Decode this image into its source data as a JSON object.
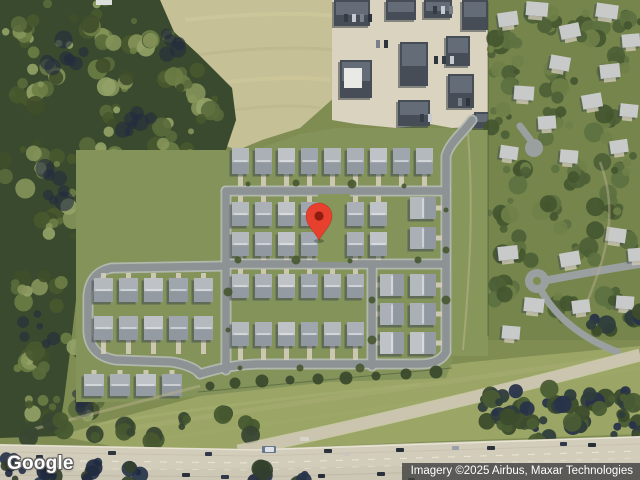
{
  "branding": {
    "logo": "Google"
  },
  "attribution": {
    "text": "Imagery ©2025 Airbus, Maxar Technologies",
    "bg": "#424242",
    "fg": "#ffffff"
  },
  "marker": {
    "cx": 319,
    "cy": 216,
    "tipY": 240,
    "r": 13,
    "color": "#E8402F",
    "inner_color": "#8E1D10",
    "inner_r": 4.6
  },
  "palette": {
    "grass": "#7f8d52",
    "slope": "#9ba566",
    "field": "#c6c096",
    "forest_base": "#3a4a2e",
    "forest_shadow": "#232c40",
    "sub_base": "#83935a",
    "belt": "#87975c",
    "road_edge": "#b7bbb6",
    "road": "#8d9394",
    "drive": "#d3cdba",
    "pavement": "#dad3bf",
    "building": "#474d57",
    "building_top": "#6b7480",
    "roofs": [
      "#b4b9be",
      "#aab0b6",
      "#bfc3c7",
      "#9fa6ad"
    ],
    "roof_front": "#8d949c",
    "roof_ridge": "#e8eaec",
    "house_shadow": "#3c4450",
    "hood_roof": "#c7cac9",
    "hood_grass": "#75854b",
    "highway": "#d2ccba",
    "frontage": "#cbc5b0",
    "forest_trees": [
      "#5a6c3c",
      "#48592f",
      "#6d7e46",
      "#86955a",
      "#3f4e2a",
      "#93a367"
    ],
    "hood_trees": [
      "#4c5f36",
      "#5d7040",
      "#44552f",
      "#6f8148"
    ],
    "band_trees": [
      "#3c4c2c",
      "#2f3d3c",
      "#4a5c34",
      "#28334a"
    ],
    "strip_trees": [
      "#47582f",
      "#394733"
    ],
    "overlay_trees": [
      "#26334a",
      "#33402c",
      "#1f2a40"
    ]
  },
  "scene": {
    "polys": {
      "field": "150,0 336,0 336,96 300,128 262,140 238,150 226,146 236,120 232,88 198,54 174,32 160,0",
      "slope": "60,436 110,420 200,396 330,380 470,362 640,346 640,434 420,442 240,450 120,448",
      "forest": "0,0 160,0 174,32 198,54 232,88 236,120 226,150 236,162 230,198 204,234 168,252 120,258 86,264 76,300 70,352 64,400 58,436 0,438",
      "commercial": "332,0 490,0 490,126 452,128 430,124 396,128 356,124 332,120",
      "sub_base": "76,150 226,150 238,156 300,134 336,128 452,128 452,362 446,378 330,382 200,396 140,402 76,402",
      "highway": "0,444 150,447 255,449 420,443 640,436 640,480 0,480",
      "highway_lower": "0,472 640,462 640,480 0,480"
    },
    "belt": {
      "x": 452,
      "y": 130,
      "w": 36,
      "h": 226
    },
    "white_box": {
      "x": 96,
      "y": 0,
      "w": 16,
      "h": 5
    },
    "gap_patch": {
      "x": 318,
      "y": 194,
      "w": 32,
      "h": 68
    },
    "sub_roads": [
      "M472,120 C462,134 450,142 446,156 L446,352",
      "M226,191 L446,191",
      "M226,191 L226,370",
      "M226,264 L446,264",
      "M372,264 L372,366",
      "M200,374 Q232,364 260,364 L420,364 Q440,364 446,352",
      "M226,266 L112,268",
      "M112,268 Q90,272 88,296 L88,332 Q90,356 116,360 L172,362 Q194,366 200,374"
    ],
    "hood_roads": [
      {
        "d": "M520,126 L532,142",
        "w": 7
      },
      {
        "d": "M548,280 C580,274 614,268 640,264",
        "w": 8
      },
      {
        "d": "M542,292 C558,320 586,340 618,352",
        "w": 7
      }
    ],
    "culdesacs": [
      {
        "x": 534,
        "y": 148,
        "r": 9,
        "island": 0
      },
      {
        "x": 537,
        "y": 281,
        "r": 12,
        "island": 4
      }
    ],
    "house_rows": [
      {
        "x": 232,
        "y": 148,
        "n": 9,
        "dx": 23,
        "w": 17,
        "h": 26,
        "f": "s",
        "ry": 186
      },
      {
        "x": 232,
        "y": 202,
        "n": 7,
        "dx": 23,
        "w": 17,
        "h": 24,
        "f": "n",
        "ry": 196,
        "skip": [
          4
        ]
      },
      {
        "x": 232,
        "y": 232,
        "n": 7,
        "dx": 23,
        "w": 17,
        "h": 24,
        "f": "s",
        "ry": 260,
        "skip": [
          4
        ]
      },
      {
        "x": 232,
        "y": 274,
        "n": 6,
        "dx": 23,
        "w": 17,
        "h": 24,
        "f": "n",
        "ry": 269
      },
      {
        "x": 232,
        "y": 322,
        "n": 6,
        "dx": 23,
        "w": 17,
        "h": 24,
        "f": "s",
        "ry": 360
      },
      {
        "x": 94,
        "y": 278,
        "n": 5,
        "dx": 25,
        "w": 19,
        "h": 24,
        "f": "n",
        "ry": 273
      },
      {
        "x": 94,
        "y": 316,
        "n": 5,
        "dx": 25,
        "w": 19,
        "h": 24,
        "f": "s",
        "ry": 354
      },
      {
        "x": 84,
        "y": 374,
        "n": 4,
        "dx": 26,
        "w": 20,
        "h": 22,
        "f": "n",
        "ry": 370
      },
      {
        "x": 410,
        "y": 197,
        "n": 2,
        "dy": 30,
        "w": 26,
        "h": 22,
        "f": "e",
        "rx": 442
      },
      {
        "x": 410,
        "y": 274,
        "n": 3,
        "dy": 29,
        "w": 26,
        "h": 22,
        "f": "e",
        "rx": 442
      },
      {
        "x": 380,
        "y": 274,
        "n": 3,
        "dy": 29,
        "w": 24,
        "h": 22,
        "f": "w",
        "rx": 376
      }
    ],
    "buildings": [
      [
        334,
        0,
        36,
        26
      ],
      [
        386,
        0,
        30,
        20
      ],
      [
        424,
        0,
        28,
        18
      ],
      [
        462,
        0,
        26,
        30
      ],
      [
        340,
        60,
        32,
        38
      ],
      [
        400,
        42,
        28,
        44
      ],
      [
        398,
        100,
        32,
        26
      ],
      [
        446,
        36,
        24,
        30
      ],
      [
        448,
        74,
        26,
        34
      ],
      [
        474,
        112,
        16,
        16
      ]
    ],
    "white_roof": {
      "x": 344,
      "y": 68,
      "w": 18,
      "h": 20
    },
    "com_cars": [
      [
        344,
        14
      ],
      [
        352,
        14
      ],
      [
        360,
        14
      ],
      [
        368,
        14
      ],
      [
        433,
        6
      ],
      [
        441,
        6
      ],
      [
        449,
        6
      ],
      [
        434,
        56
      ],
      [
        442,
        56
      ],
      [
        450,
        56
      ],
      [
        458,
        98
      ],
      [
        466,
        98
      ],
      [
        420,
        114
      ],
      [
        428,
        114
      ],
      [
        376,
        40
      ],
      [
        384,
        40
      ]
    ],
    "hood_houses": [
      [
        498,
        12,
        20,
        14,
        -8
      ],
      [
        526,
        2,
        22,
        14,
        5
      ],
      [
        560,
        24,
        20,
        14,
        -12
      ],
      [
        596,
        4,
        22,
        14,
        8
      ],
      [
        622,
        34,
        18,
        13,
        -5
      ],
      [
        550,
        56,
        20,
        14,
        10
      ],
      [
        600,
        64,
        20,
        14,
        -6
      ],
      [
        514,
        86,
        20,
        14,
        4
      ],
      [
        582,
        94,
        20,
        14,
        -10
      ],
      [
        620,
        104,
        18,
        13,
        6
      ],
      [
        538,
        116,
        18,
        13,
        -4
      ],
      [
        500,
        146,
        18,
        13,
        8
      ],
      [
        610,
        140,
        18,
        13,
        -8
      ],
      [
        560,
        150,
        18,
        13,
        5
      ],
      [
        498,
        246,
        20,
        14,
        -6
      ],
      [
        524,
        298,
        20,
        14,
        6
      ],
      [
        560,
        252,
        20,
        14,
        -10
      ],
      [
        606,
        228,
        20,
        14,
        8
      ],
      [
        628,
        248,
        18,
        13,
        -5
      ],
      [
        502,
        326,
        18,
        13,
        5
      ],
      [
        572,
        300,
        18,
        13,
        -7
      ],
      [
        616,
        296,
        18,
        13,
        4
      ]
    ],
    "clusters": {
      "forest": [
        [
          30,
          30,
          34,
          14
        ],
        [
          90,
          25,
          30,
          12
        ],
        [
          150,
          40,
          26,
          10
        ],
        [
          40,
          90,
          32,
          13
        ],
        [
          110,
          90,
          30,
          12
        ],
        [
          180,
          80,
          26,
          10
        ],
        [
          30,
          160,
          30,
          12
        ],
        [
          100,
          150,
          30,
          12
        ],
        [
          170,
          140,
          26,
          10
        ],
        [
          210,
          110,
          20,
          8
        ],
        [
          60,
          220,
          30,
          12
        ],
        [
          130,
          210,
          28,
          11
        ],
        [
          195,
          200,
          22,
          9
        ],
        [
          40,
          290,
          26,
          11
        ],
        [
          100,
          290,
          22,
          9
        ],
        [
          30,
          360,
          24,
          10
        ],
        [
          80,
          350,
          20,
          8
        ],
        [
          40,
          410,
          22,
          9
        ],
        [
          90,
          410,
          16,
          7
        ],
        [
          210,
          170,
          16,
          7
        ],
        [
          150,
          250,
          18,
          7
        ],
        [
          215,
          230,
          14,
          6
        ],
        [
          214,
          168,
          12,
          5
        ]
      ],
      "forest_shadow": [
        [
          70,
          60,
          30,
          8
        ],
        [
          140,
          120,
          28,
          7
        ],
        [
          60,
          180,
          26,
          7
        ],
        [
          120,
          250,
          22,
          6
        ],
        [
          40,
          330,
          20,
          6
        ],
        [
          170,
          40,
          20,
          5
        ],
        [
          90,
          320,
          18,
          5
        ],
        [
          75,
          395,
          18,
          5
        ]
      ],
      "hood": [
        [
          500,
          40,
          20,
          9
        ],
        [
          545,
          25,
          22,
          9
        ],
        [
          590,
          30,
          22,
          9
        ],
        [
          628,
          20,
          16,
          7
        ],
        [
          510,
          75,
          18,
          8
        ],
        [
          560,
          85,
          20,
          9
        ],
        [
          615,
          70,
          18,
          8
        ],
        [
          500,
          120,
          18,
          8
        ],
        [
          555,
          125,
          20,
          8
        ],
        [
          605,
          120,
          18,
          8
        ],
        [
          525,
          170,
          22,
          9
        ],
        [
          575,
          170,
          20,
          8
        ],
        [
          620,
          165,
          18,
          8
        ],
        [
          500,
          215,
          18,
          8
        ],
        [
          555,
          215,
          20,
          8
        ],
        [
          610,
          210,
          18,
          8
        ],
        [
          520,
          250,
          18,
          7
        ],
        [
          590,
          245,
          18,
          7
        ],
        [
          630,
          240,
          14,
          6
        ],
        [
          505,
          290,
          16,
          7
        ],
        [
          560,
          305,
          16,
          7
        ],
        [
          612,
          300,
          16,
          7
        ],
        [
          635,
          320,
          12,
          5
        ],
        [
          433,
          140,
          10,
          5
        ],
        [
          333,
          226,
          11,
          6
        ]
      ],
      "band": [
        [
          492,
          398,
          16,
          7
        ],
        [
          522,
          408,
          18,
          8
        ],
        [
          556,
          404,
          18,
          8
        ],
        [
          590,
          400,
          16,
          7
        ],
        [
          622,
          398,
          16,
          7
        ],
        [
          638,
          412,
          12,
          5
        ],
        [
          508,
          428,
          16,
          7
        ],
        [
          545,
          430,
          16,
          7
        ],
        [
          582,
          428,
          16,
          7
        ],
        [
          618,
          426,
          14,
          6
        ],
        [
          636,
          434,
          12,
          5
        ],
        [
          498,
          414,
          14,
          6
        ],
        [
          600,
          330,
          14,
          6
        ],
        [
          632,
          318,
          12,
          5
        ]
      ],
      "strip": [
        [
          60,
          425,
          10,
          5
        ],
        [
          130,
          428,
          9,
          4
        ],
        [
          185,
          420,
          8,
          4
        ],
        [
          28,
          434,
          8,
          4
        ],
        [
          95,
          437,
          7,
          3
        ],
        [
          152,
          440,
          6,
          3
        ],
        [
          250,
          430,
          9,
          4
        ],
        [
          225,
          415,
          7,
          3
        ]
      ],
      "overlay": [
        [
          12,
          470,
          14,
          7
        ],
        [
          48,
          474,
          13,
          6
        ],
        [
          92,
          472,
          12,
          6
        ],
        [
          135,
          476,
          11,
          5
        ],
        [
          262,
          477,
          10,
          5
        ],
        [
          300,
          479,
          8,
          4
        ]
      ]
    },
    "tree_row": [
      [
        210,
        386
      ],
      [
        235,
        383
      ],
      [
        262,
        381
      ],
      [
        290,
        380
      ],
      [
        318,
        379
      ],
      [
        346,
        378
      ],
      [
        376,
        376
      ],
      [
        406,
        374
      ],
      [
        436,
        372
      ]
    ],
    "street_dots": [
      [
        248,
        184
      ],
      [
        296,
        183
      ],
      [
        352,
        184
      ],
      [
        404,
        186
      ],
      [
        238,
        260
      ],
      [
        296,
        260
      ],
      [
        350,
        261
      ],
      [
        418,
        260
      ],
      [
        228,
        292
      ],
      [
        228,
        330
      ],
      [
        372,
        300
      ],
      [
        372,
        340
      ],
      [
        446,
        210
      ],
      [
        446,
        250
      ],
      [
        446,
        300
      ],
      [
        240,
        368
      ],
      [
        300,
        368
      ],
      [
        360,
        368
      ]
    ],
    "frontage": "M238,451 C340,430 500,392 640,355",
    "lane_lines": [
      {
        "d": "M0,445 L255,450 L640,437",
        "c": "#ece7d8",
        "w": 1.3,
        "o": 0.85
      },
      {
        "d": "M0,452 L255,456 L640,444",
        "c": "#c1bba7",
        "w": 1,
        "o": 0.6
      },
      {
        "d": "M0,460 L255,463 L640,451",
        "c": "#efeadb",
        "w": 1.1,
        "o": 0.8,
        "dash": "7 9"
      },
      {
        "d": "M0,468 L255,470 L640,458",
        "c": "#e9e4d5",
        "w": 1,
        "o": 0.6,
        "dash": "7 9"
      },
      {
        "d": "M0,475 L255,477 L640,466",
        "c": "#b3ad99",
        "w": 1,
        "o": 0.5
      }
    ],
    "slope_streaks": [
      {
        "d": "M120,430 C260,408 430,384 630,356",
        "c": "#a9b274",
        "w": 5,
        "o": 0.45
      },
      {
        "d": "M150,440 C300,420 470,396 640,368",
        "c": "#9fa96c",
        "w": 4,
        "o": 0.4
      },
      {
        "d": "M90,425 C200,408 300,396 420,384",
        "c": "#aab375",
        "w": 3,
        "o": 0.4
      }
    ],
    "field_streaks": [
      {
        "d": "M185,20 C240,14 300,12 334,16",
        "c": "#d2cb9f",
        "w": 4,
        "o": 0.5
      },
      {
        "d": "M195,55 C250,48 300,46 334,50",
        "c": "#b7b288",
        "w": 3,
        "o": 0.45
      },
      {
        "d": "M205,85 C255,78 300,76 330,80",
        "c": "#d2cb9f",
        "w": 4,
        "o": 0.45
      },
      {
        "d": "M215,112 C260,106 295,104 320,108",
        "c": "#b7b288",
        "w": 3,
        "o": 0.4
      }
    ],
    "misc_paths": [
      {
        "d": "M468,134 C473,200 471,262 463,350",
        "c": "#b9b28a",
        "w": 2,
        "o": 0.55
      },
      {
        "d": "M30,430 L200,386",
        "c": "#b7b189",
        "w": 3,
        "o": 0.5
      },
      {
        "d": "M488,2 L488,336",
        "c": "#39442c",
        "w": 1,
        "o": 0.5
      },
      {
        "d": "M198,392 L452,368",
        "c": "#3c4630",
        "w": 1,
        "o": 0.45
      },
      {
        "d": "M600,162 C622,220 600,268 588,300",
        "c": "#b5ae8e",
        "w": 2.5,
        "o": 0.5
      }
    ],
    "vehicles_upper": [
      [
        108,
        451,
        8,
        4,
        "#2e3540"
      ],
      [
        205,
        452,
        7,
        4,
        "#30374a"
      ],
      [
        262,
        446,
        14,
        7,
        "#67778e"
      ],
      [
        300,
        437,
        9,
        4,
        "#d6d4cb"
      ],
      [
        324,
        449,
        8,
        4,
        "#2b323c"
      ],
      [
        343,
        452,
        7,
        4,
        "#c8c6bd"
      ],
      [
        396,
        448,
        8,
        4,
        "#272e38"
      ],
      [
        452,
        446,
        7,
        4,
        "#9aa0a8"
      ],
      [
        487,
        446,
        8,
        4,
        "#2b323c"
      ],
      [
        560,
        442,
        7,
        4,
        "#30384a"
      ],
      [
        588,
        443,
        8,
        4,
        "#262d36"
      ],
      [
        36,
        455,
        7,
        4,
        "#2e3540"
      ]
    ],
    "vehicles_lower": [
      [
        182,
        473,
        8,
        4,
        "#2b313c"
      ],
      [
        221,
        475,
        8,
        4,
        "#323848"
      ],
      [
        318,
        474,
        7,
        4,
        "#262c38"
      ],
      [
        377,
        472,
        8,
        4,
        "#2b313c"
      ],
      [
        408,
        478,
        7,
        3,
        "#30363f"
      ]
    ]
  }
}
